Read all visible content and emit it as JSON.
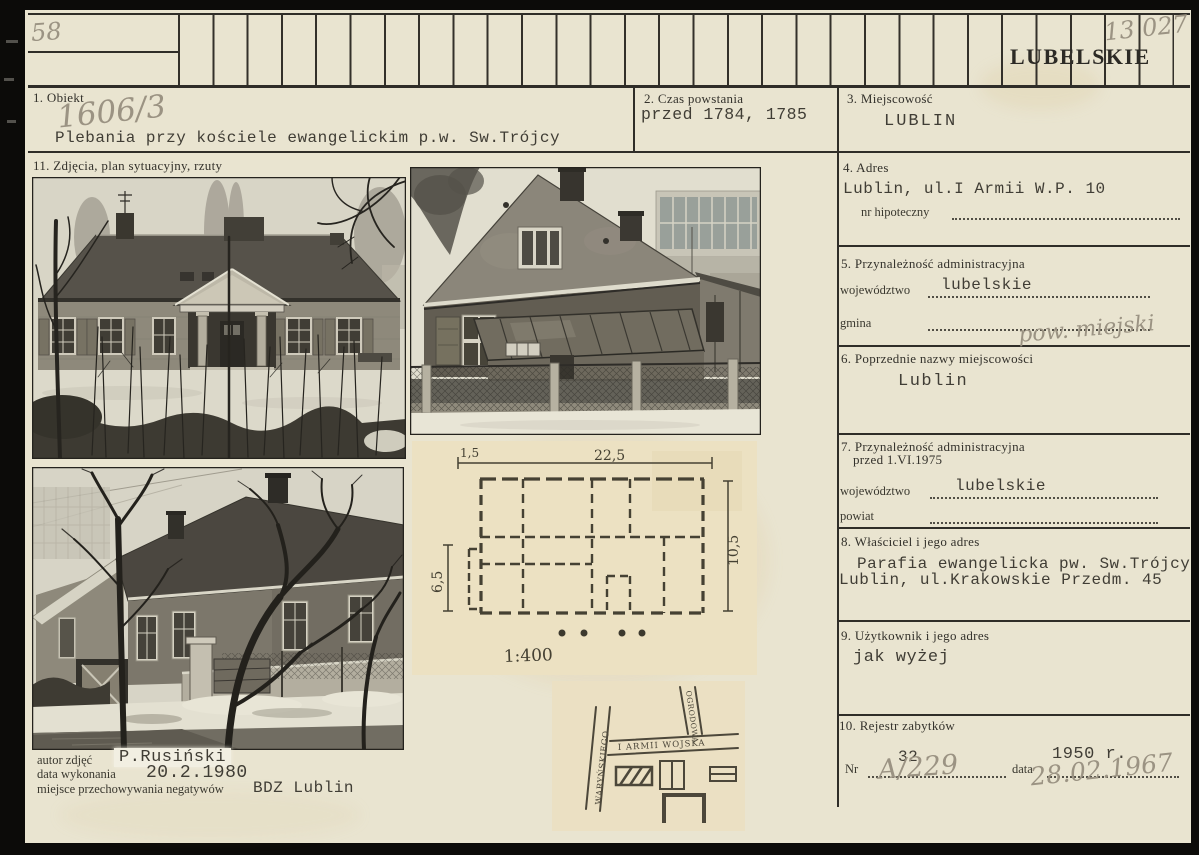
{
  "colors": {
    "card_bg": "#e9e4d0",
    "ink": "#2f2d28",
    "typewriter_ink": "#403d35",
    "pencil": "#9b9383",
    "plan_paper": "#ece1c2"
  },
  "header": {
    "page_number": "58",
    "catalog_number": "13 027",
    "voivodeship": "LUBELSKIE"
  },
  "fields": {
    "obiekt": {
      "label": "1. Obiekt",
      "inventory_no": "1606/3",
      "value": "Plebania przy kościele ewangelickim p.w. Sw.Trójcy"
    },
    "czas_powstania": {
      "label": "2. Czas powstania",
      "value": "przed 1784, 1785"
    },
    "miejscowosc": {
      "label": "3. Miejscowość",
      "value": "LUBLIN"
    },
    "adres": {
      "label": "4. Adres",
      "value": "Lublin, ul.I Armii W.P. 10",
      "hipoteczny_label": "nr hipoteczny"
    },
    "przynaleznosc": {
      "label": "5. Przynależność administracyjna",
      "wojewodztwo_label": "województwo",
      "wojewodztwo": "lubelskie",
      "gmina_label": "gmina",
      "gmina_note": "pow. miejski"
    },
    "poprzednie_nazwy": {
      "label": "6. Poprzednie nazwy miejscowości",
      "value": "Lublin"
    },
    "przynaleznosc_1975": {
      "label": "7. Przynależność administracyjna",
      "label_line2": "przed 1.VI.1975",
      "wojewodztwo_label": "województwo",
      "wojewodztwo": "lubelskie",
      "powiat_label": "powiat"
    },
    "wlasciciel": {
      "label": "8. Właściciel i jego adres",
      "line1": "Parafia ewangelicka pw. Sw.Trójcy",
      "line2": "Lublin, ul.Krakowskie Przedm. 45"
    },
    "uzytkownik": {
      "label": "9. Użytkownik i jego adres",
      "value": "jak wyżej"
    },
    "rejestr": {
      "label": "10. Rejestr zabytków",
      "nr_label": "Nr",
      "nr": "32",
      "nr_note": "A/229",
      "data_label": "data",
      "data": "1950 r.",
      "data_note": "28.02.1967"
    },
    "zdjecia": {
      "label": "11. Zdjęcia, plan sytuacyjny, rzuty"
    }
  },
  "credits": {
    "autor_label": "autor zdjęć",
    "autor": "P.Rusiński",
    "data_label": "data wykonania",
    "data": "20.2.1980",
    "negatywy_label": "miejsce przechowywania negatywów",
    "negatywy": "BDZ Lublin"
  },
  "floor_plan": {
    "dim_top_left": "1,5",
    "dim_top": "22,5",
    "dim_left": "6,5",
    "dim_right": "10,5",
    "scale": "1:400"
  },
  "site_plan": {
    "street_main": "I ARMII WOJSKA",
    "street_left": "WARYŃSKIEGO",
    "street_right": "OGRODOWA"
  }
}
